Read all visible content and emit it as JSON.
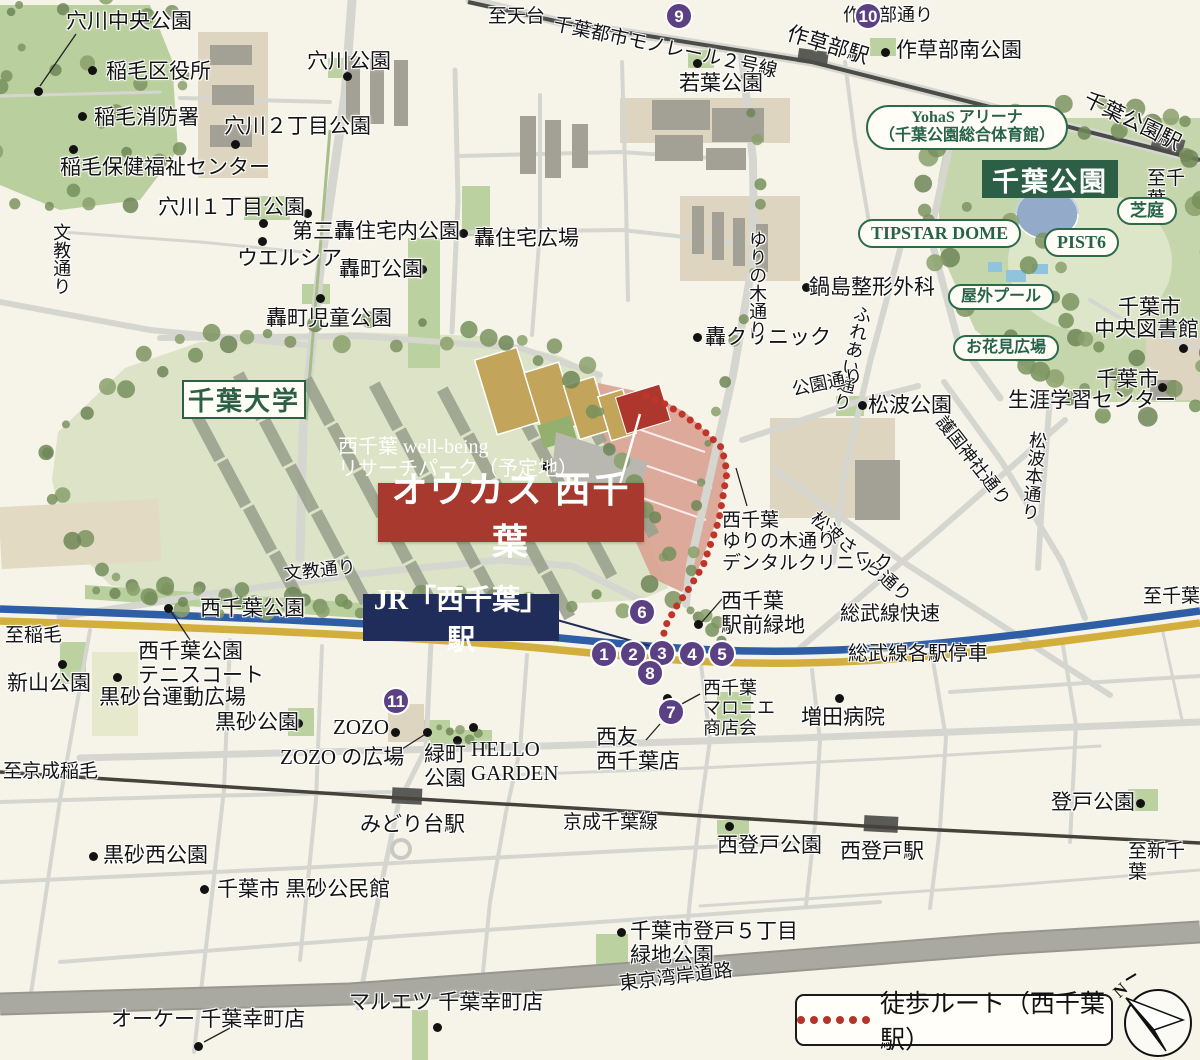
{
  "colors": {
    "background": "#f6f3e9",
    "road": "#d6d6d1",
    "park_green": "#c6d6ac",
    "campus_green": "#dce3c6",
    "site_pink": "#d9a393",
    "accent_red": "#ad372c",
    "badge_purple": "#5b4184",
    "rail_blue": "#2e5ea6",
    "rail_yellow": "#d2ae3c",
    "navy_box": "#202c5a",
    "green_box": "#2c5f45",
    "route_red": "#c0352a"
  },
  "boxes": {
    "chiba_park": "千葉公園",
    "chiba_univ": "千葉大学",
    "oukas": "オウカス 西千葉",
    "jr_station": "JR「西千葉」駅"
  },
  "legend": {
    "route": "徒歩ルート（西千葉駅）",
    "north": "N"
  },
  "pills": [
    {
      "t": "YohaS アリーナ\n（千葉公園総合体育館）",
      "x": 866,
      "y": 105,
      "fs": 16
    },
    {
      "t": "TIPSTAR DOME",
      "x": 858,
      "y": 219,
      "fs": 18
    },
    {
      "t": "PIST6",
      "x": 1044,
      "y": 228,
      "fs": 18
    },
    {
      "t": "芝庭",
      "x": 1117,
      "y": 197,
      "fs": 17
    },
    {
      "t": "屋外プール",
      "x": 948,
      "y": 284,
      "fs": 16
    },
    {
      "t": "お花見広場",
      "x": 953,
      "y": 335,
      "fs": 16
    }
  ],
  "badges": [
    {
      "n": "9",
      "x": 679,
      "y": 16
    },
    {
      "n": "10",
      "x": 868,
      "y": 16
    },
    {
      "n": "6",
      "x": 642,
      "y": 612
    },
    {
      "n": "1",
      "x": 604,
      "y": 654
    },
    {
      "n": "2",
      "x": 633,
      "y": 654
    },
    {
      "n": "3",
      "x": 662,
      "y": 653
    },
    {
      "n": "4",
      "x": 692,
      "y": 654
    },
    {
      "n": "5",
      "x": 722,
      "y": 654
    },
    {
      "n": "8",
      "x": 650,
      "y": 673
    },
    {
      "n": "7",
      "x": 671,
      "y": 712
    },
    {
      "n": "11",
      "x": 396,
      "y": 701
    }
  ],
  "labels": [
    {
      "t": "穴川中央公園",
      "x": 66,
      "y": 10,
      "fs": 21
    },
    {
      "t": "稲毛区役所",
      "x": 106,
      "y": 60,
      "fs": 21
    },
    {
      "t": "稲毛消防署",
      "x": 94,
      "y": 106,
      "fs": 21
    },
    {
      "t": "穴川公園",
      "x": 307,
      "y": 50,
      "fs": 21
    },
    {
      "t": "穴川２丁目公園",
      "x": 224,
      "y": 115,
      "fs": 21
    },
    {
      "t": "稲毛保健福祉センター",
      "x": 60,
      "y": 156,
      "fs": 21
    },
    {
      "t": "穴川１丁目公園",
      "x": 158,
      "y": 196,
      "fs": 21
    },
    {
      "t": "第三轟住宅内公園",
      "x": 292,
      "y": 220,
      "fs": 21
    },
    {
      "t": "ウエルシア",
      "x": 237,
      "y": 247,
      "fs": 21
    },
    {
      "t": "轟住宅広場",
      "x": 474,
      "y": 227,
      "fs": 21
    },
    {
      "t": "轟町公園",
      "x": 339,
      "y": 258,
      "fs": 21
    },
    {
      "t": "轟町児童公園",
      "x": 266,
      "y": 307,
      "fs": 21
    },
    {
      "t": "至天台",
      "x": 488,
      "y": 6,
      "fs": 19
    },
    {
      "t": "千葉都市モノレール２号線",
      "x": 556,
      "y": 14,
      "fs": 19,
      "rot": 12
    },
    {
      "t": "若葉公園",
      "x": 679,
      "y": 72,
      "fs": 21
    },
    {
      "t": "作草部駅",
      "x": 791,
      "y": 22,
      "fs": 21,
      "rot": 17
    },
    {
      "t": "作草部通り",
      "x": 843,
      "y": 5,
      "fs": 18
    },
    {
      "t": "作草部南公園",
      "x": 896,
      "y": 39,
      "fs": 21
    },
    {
      "t": "千葉公園駅",
      "x": 1090,
      "y": 88,
      "fs": 21,
      "rot": 26
    },
    {
      "t": "至千葉",
      "x": 1147,
      "y": 168,
      "fs": 19
    },
    {
      "t": "鍋島整形外科",
      "x": 809,
      "y": 276,
      "fs": 21
    },
    {
      "t": "轟クリニック",
      "x": 705,
      "y": 326,
      "fs": 21
    },
    {
      "t": "ゆりの木通り",
      "x": 747,
      "y": 230,
      "fs": 18,
      "vert": true
    },
    {
      "t": "ふれあい通り",
      "x": 854,
      "y": 303,
      "fs": 18,
      "vert": true,
      "rot": 13
    },
    {
      "t": "公園通り",
      "x": 790,
      "y": 380,
      "fs": 18,
      "rot": -12
    },
    {
      "t": "護国神社通り",
      "x": 948,
      "y": 412,
      "fs": 18,
      "rot": 52
    },
    {
      "t": "松波本通り",
      "x": 1028,
      "y": 430,
      "fs": 18,
      "vert": true,
      "rot": 6
    },
    {
      "t": "松波公園",
      "x": 868,
      "y": 394,
      "fs": 21
    },
    {
      "t": "千葉市",
      "x": 1118,
      "y": 296,
      "fs": 21
    },
    {
      "t": "中央図書館",
      "x": 1094,
      "y": 318,
      "fs": 21
    },
    {
      "t": "千葉市",
      "x": 1096,
      "y": 368,
      "fs": 21
    },
    {
      "t": "生涯学習センター",
      "x": 1008,
      "y": 389,
      "fs": 21
    },
    {
      "t": "西千葉 well-being\nリサーチパーク（予定地）",
      "x": 338,
      "y": 436,
      "fs": 20,
      "color": "#ffffff"
    },
    {
      "t": "文教通り",
      "x": 51,
      "y": 223,
      "fs": 18,
      "vert": true
    },
    {
      "t": "文教通り",
      "x": 283,
      "y": 564,
      "fs": 18,
      "rot": -6
    },
    {
      "t": "松波さくら通り",
      "x": 820,
      "y": 508,
      "fs": 18,
      "rot": 41
    },
    {
      "t": "西千葉\nゆりの木通り\nデンタルクリニック",
      "x": 722,
      "y": 510,
      "fs": 19
    },
    {
      "t": "西千葉公園",
      "x": 200,
      "y": 597,
      "fs": 21
    },
    {
      "t": "西千葉\n駅前緑地",
      "x": 721,
      "y": 590,
      "fs": 21
    },
    {
      "t": "総武線快速",
      "x": 840,
      "y": 603,
      "fs": 20
    },
    {
      "t": "総武線各駅停車",
      "x": 848,
      "y": 643,
      "fs": 20
    },
    {
      "t": "至稲毛",
      "x": 5,
      "y": 625,
      "fs": 19
    },
    {
      "t": "至千葉",
      "x": 1143,
      "y": 586,
      "fs": 19
    },
    {
      "t": "新山公園",
      "x": 7,
      "y": 672,
      "fs": 21
    },
    {
      "t": "西千葉公園\nテニスコート",
      "x": 138,
      "y": 640,
      "fs": 21
    },
    {
      "t": "黒砂台運動広場",
      "x": 99,
      "y": 686,
      "fs": 21
    },
    {
      "t": "黒砂公園",
      "x": 215,
      "y": 711,
      "fs": 21
    },
    {
      "t": "ZOZO",
      "x": 333,
      "y": 716,
      "fs": 21
    },
    {
      "t": "ZOZO の広場",
      "x": 280,
      "y": 746,
      "fs": 21
    },
    {
      "t": "緑町\n公園",
      "x": 424,
      "y": 743,
      "fs": 21
    },
    {
      "t": "HELLO\nGARDEN",
      "x": 471,
      "y": 738,
      "fs": 21
    },
    {
      "t": "西千葉\nマロニエ\n商店会",
      "x": 703,
      "y": 678,
      "fs": 18
    },
    {
      "t": "増田病院",
      "x": 801,
      "y": 706,
      "fs": 21
    },
    {
      "t": "西友\n西千葉店",
      "x": 596,
      "y": 726,
      "fs": 21
    },
    {
      "t": "みどり台駅",
      "x": 360,
      "y": 813,
      "fs": 21
    },
    {
      "t": "京成千葉線",
      "x": 563,
      "y": 812,
      "fs": 19
    },
    {
      "t": "西登戸公園",
      "x": 717,
      "y": 834,
      "fs": 21
    },
    {
      "t": "西登戸駅",
      "x": 840,
      "y": 840,
      "fs": 21
    },
    {
      "t": "登戸公園",
      "x": 1051,
      "y": 791,
      "fs": 21
    },
    {
      "t": "至新千葉",
      "x": 1128,
      "y": 841,
      "fs": 19
    },
    {
      "t": "至京成稲毛",
      "x": 3,
      "y": 761,
      "fs": 19
    },
    {
      "t": "黒砂西公園",
      "x": 103,
      "y": 844,
      "fs": 21
    },
    {
      "t": "千葉市 黒砂公民館",
      "x": 217,
      "y": 878,
      "fs": 21
    },
    {
      "t": "千葉市登戸５丁目\n緑地公園",
      "x": 630,
      "y": 920,
      "fs": 21
    },
    {
      "t": "東京湾岸道路",
      "x": 618,
      "y": 974,
      "fs": 19,
      "rot": -7
    },
    {
      "t": "オーケー 千葉幸町店",
      "x": 111,
      "y": 1008,
      "fs": 21
    },
    {
      "t": "マルエツ 千葉幸町店",
      "x": 349,
      "y": 991,
      "fs": 21
    }
  ],
  "dots": [
    [
      38,
      91
    ],
    [
      92,
      70
    ],
    [
      82,
      116
    ],
    [
      347,
      76
    ],
    [
      235,
      144
    ],
    [
      73,
      149
    ],
    [
      263,
      223
    ],
    [
      307,
      213
    ],
    [
      262,
      241
    ],
    [
      422,
      269
    ],
    [
      463,
      233
    ],
    [
      320,
      298
    ],
    [
      697,
      63
    ],
    [
      885,
      52
    ],
    [
      806,
      287
    ],
    [
      697,
      337
    ],
    [
      862,
      405
    ],
    [
      1183,
      348
    ],
    [
      1162,
      387
    ],
    [
      545,
      466
    ],
    [
      168,
      608
    ],
    [
      117,
      677
    ],
    [
      298,
      723
    ],
    [
      395,
      732
    ],
    [
      427,
      732
    ],
    [
      457,
      740
    ],
    [
      473,
      727
    ],
    [
      62,
      664
    ],
    [
      698,
      624
    ],
    [
      839,
      698
    ],
    [
      667,
      698
    ],
    [
      729,
      826
    ],
    [
      1140,
      803
    ],
    [
      93,
      856
    ],
    [
      204,
      889
    ],
    [
      621,
      932
    ],
    [
      198,
      1046
    ],
    [
      437,
      1027
    ]
  ]
}
